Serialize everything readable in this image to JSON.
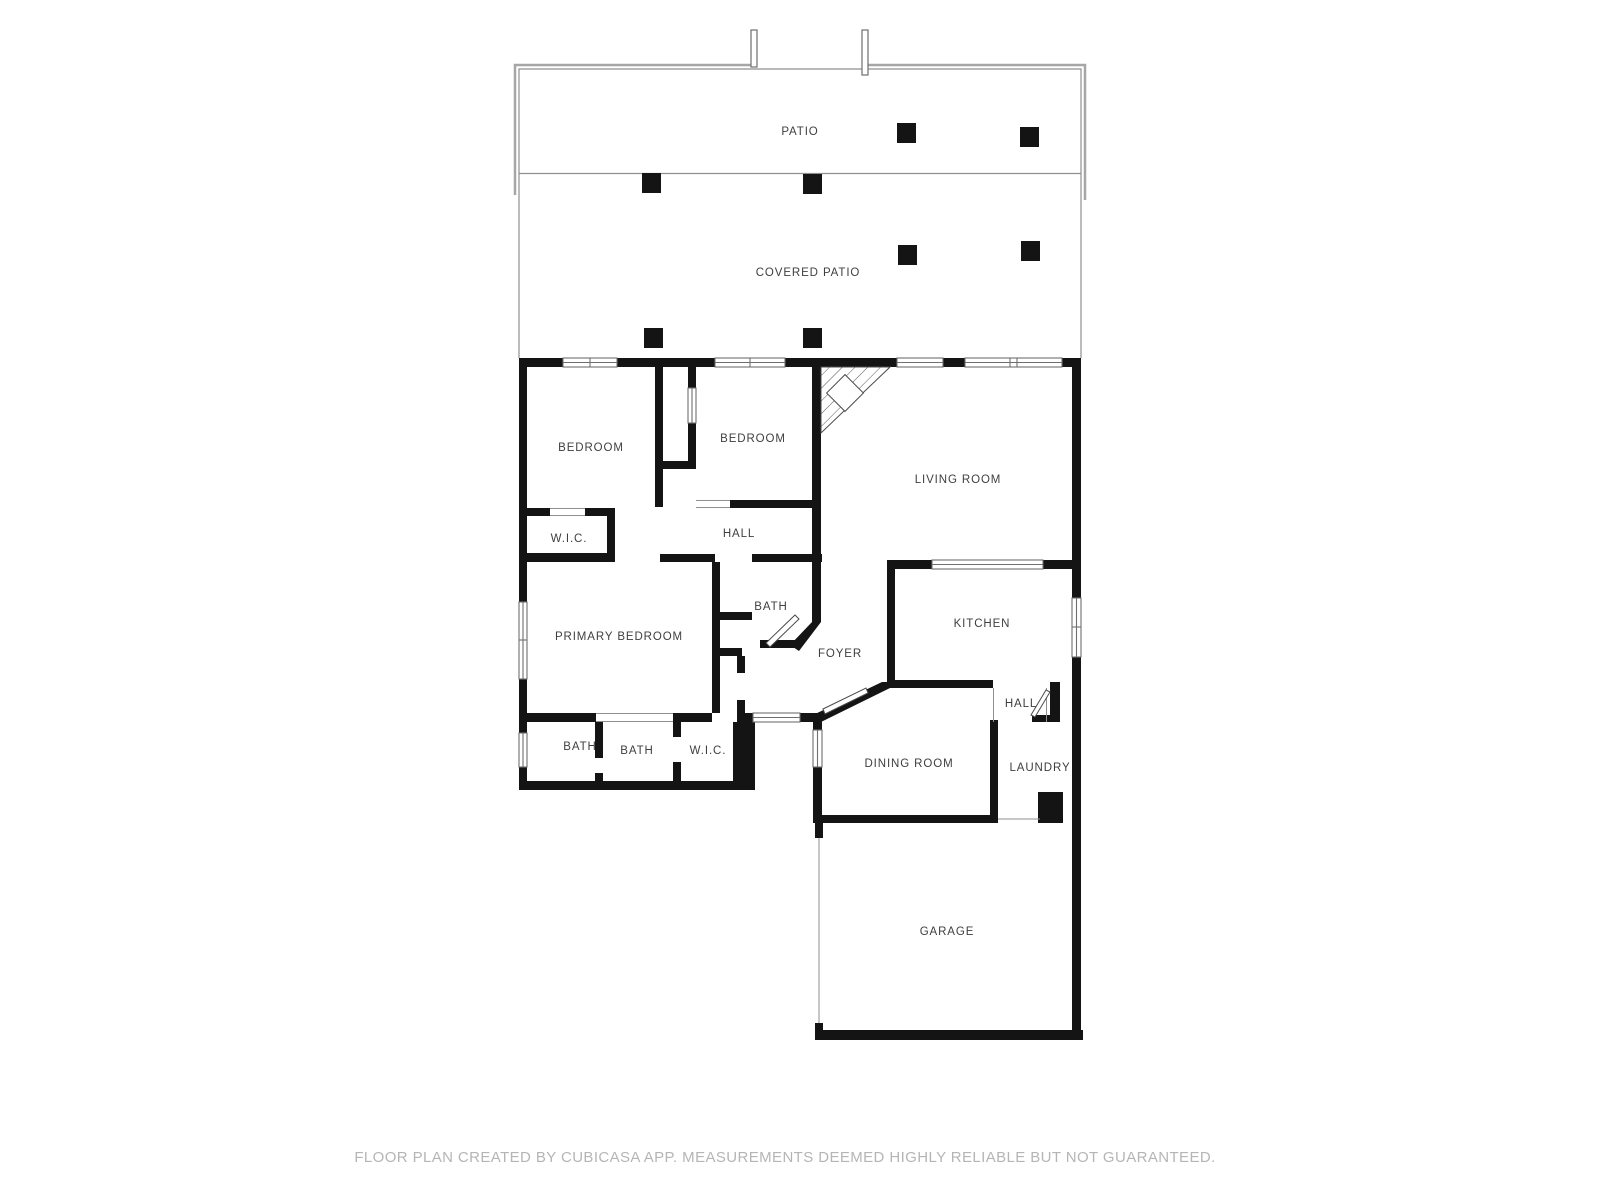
{
  "canvas": {
    "width": 1600,
    "height": 1200,
    "background": "#ffffff"
  },
  "colors": {
    "wall": "#141414",
    "label": "#3f3f3f",
    "patio_line_outer": "#a6a6a6",
    "patio_line_inner": "#8f8f8f",
    "window_line": "#6f6f6f",
    "footer": "#b5b5b5"
  },
  "rooms": [
    {
      "name": "patio",
      "label": "PATIO",
      "x": 800,
      "y": 131
    },
    {
      "name": "covered-patio",
      "label": "COVERED PATIO",
      "x": 808,
      "y": 272
    },
    {
      "name": "bedroom-1",
      "label": "BEDROOM",
      "x": 591,
      "y": 447
    },
    {
      "name": "bedroom-2",
      "label": "BEDROOM",
      "x": 753,
      "y": 438
    },
    {
      "name": "living-room",
      "label": "LIVING ROOM",
      "x": 958,
      "y": 479
    },
    {
      "name": "wic-upper",
      "label": "W.I.C.",
      "x": 569,
      "y": 538
    },
    {
      "name": "hall-bedrooms",
      "label": "HALL",
      "x": 739,
      "y": 533
    },
    {
      "name": "primary-bedroom",
      "label": "PRIMARY BEDROOM",
      "x": 619,
      "y": 636
    },
    {
      "name": "bath-primary",
      "label": "BATH",
      "x": 771,
      "y": 606
    },
    {
      "name": "kitchen",
      "label": "KITCHEN",
      "x": 982,
      "y": 623
    },
    {
      "name": "foyer",
      "label": "FOYER",
      "x": 840,
      "y": 653
    },
    {
      "name": "hall-kitchen",
      "label": "HALL",
      "x": 1021,
      "y": 703
    },
    {
      "name": "bath-left",
      "label": "BATH",
      "x": 580,
      "y": 746
    },
    {
      "name": "bath-middle",
      "label": "BATH",
      "x": 637,
      "y": 750
    },
    {
      "name": "wic-lower",
      "label": "W.I.C.",
      "x": 708,
      "y": 750
    },
    {
      "name": "dining-room",
      "label": "DINING ROOM",
      "x": 909,
      "y": 763
    },
    {
      "name": "laundry",
      "label": "LAUNDRY",
      "x": 1040,
      "y": 767
    },
    {
      "name": "garage",
      "label": "GARAGE",
      "x": 947,
      "y": 931
    }
  ],
  "pillars": [
    {
      "x": 897,
      "y": 123
    },
    {
      "x": 1020,
      "y": 127
    },
    {
      "x": 642,
      "y": 173
    },
    {
      "x": 803,
      "y": 174
    },
    {
      "x": 898,
      "y": 245
    },
    {
      "x": 1021,
      "y": 241
    },
    {
      "x": 644,
      "y": 328
    },
    {
      "x": 803,
      "y": 328
    }
  ],
  "pillar_size": {
    "w": 19,
    "h": 20
  },
  "footer": {
    "text": "FLOOR PLAN CREATED BY CUBICASA APP. MEASUREMENTS DEEMED HIGHLY RELIABLE BUT NOT GUARANTEED."
  }
}
